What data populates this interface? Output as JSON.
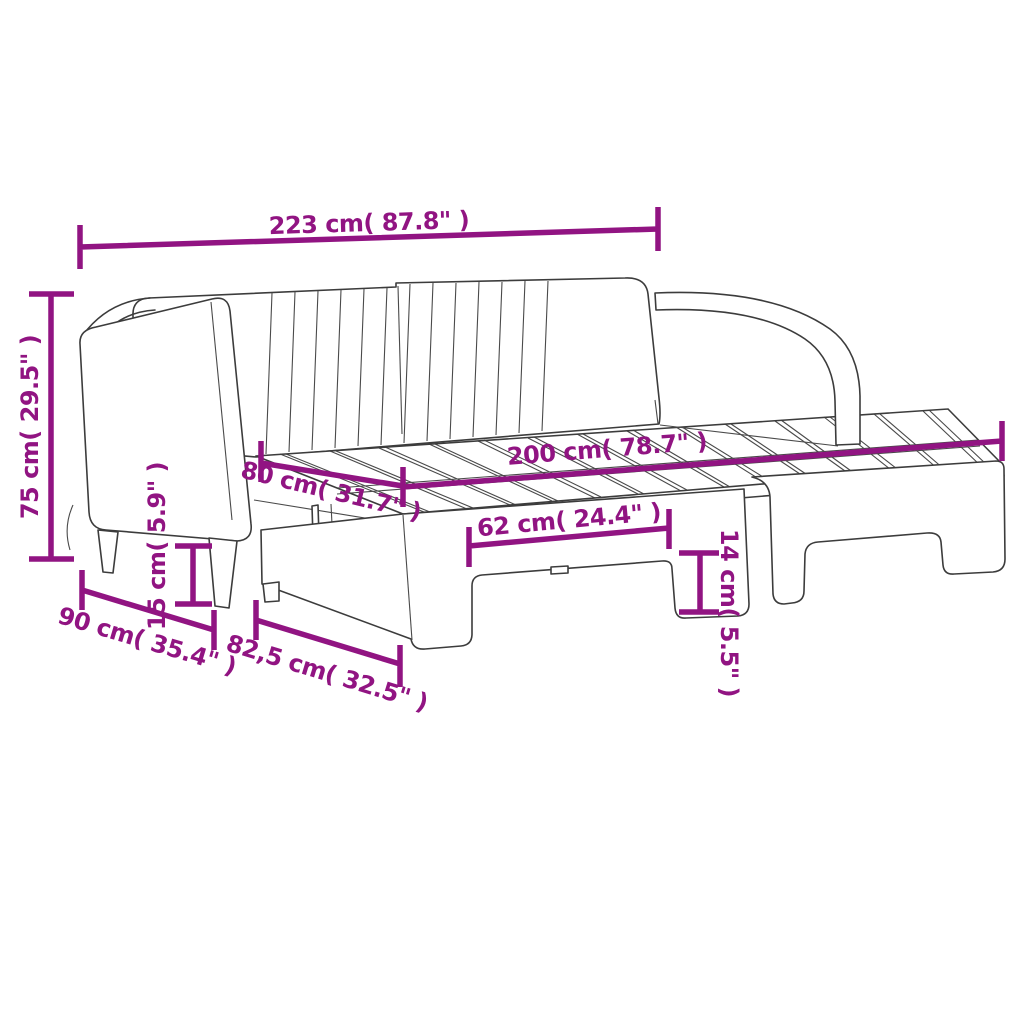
{
  "page": {
    "background_color": "#ffffff"
  },
  "diagram": {
    "subject": "Daybed with pull-out trundle bed — technical dimension line drawing",
    "style": {
      "dimension_color": "#911482",
      "outline_color": "#3c3c3c",
      "background": "#ffffff"
    },
    "dimensions": {
      "total_width": {
        "label": "223 cm( 87.8\" )",
        "cm": "223",
        "inches": "87.8"
      },
      "total_height": {
        "label": "75 cm( 29.5\" )",
        "cm": "75",
        "inches": "29.5"
      },
      "sleeping_length": {
        "label": "200 cm( 78.7\" )",
        "cm": "200",
        "inches": "78.7"
      },
      "sleeping_width": {
        "label": "80 cm( 31.7\" )",
        "cm": "80",
        "inches": "31.7"
      },
      "underbed_opening": {
        "label": "62 cm( 24.4\" )",
        "cm": "62",
        "inches": "24.4"
      },
      "leg_height": {
        "label": "15 cm( 5.9\" )",
        "cm": "15",
        "inches": "5.9"
      },
      "trundle_leg_height": {
        "label": "14 cm( 5.5\" )",
        "cm": "14",
        "inches": "5.5"
      },
      "frame_depth": {
        "label": "90 cm( 35.4\" )",
        "cm": "90",
        "inches": "35.4"
      },
      "trundle_depth": {
        "label": "82,5 cm( 32.5\" )",
        "cm": "82,5",
        "inches": "32.5"
      }
    }
  }
}
